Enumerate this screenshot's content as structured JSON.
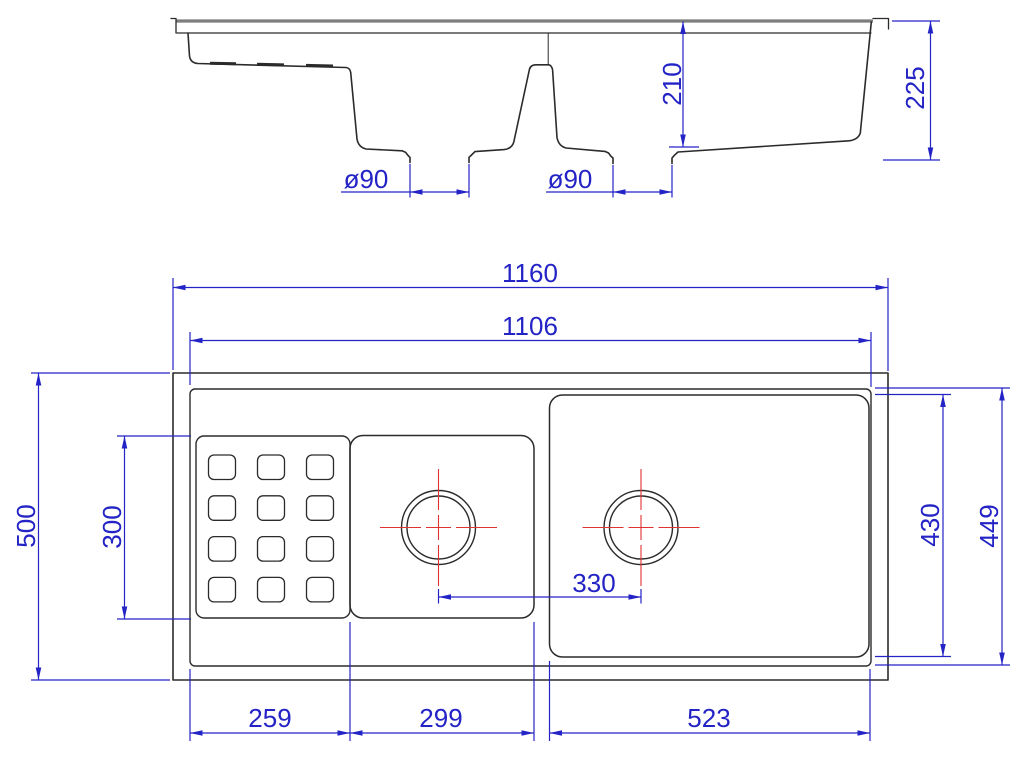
{
  "colors": {
    "dimension": "#2323c6",
    "outline": "#2b2b2b",
    "centerline": "#e03232",
    "countertop": "#7d7d7d",
    "background": "#ffffff"
  },
  "section_view": {
    "dim_drain_left": "ø90",
    "dim_drain_right": "ø90",
    "dim_bowl_depth": "210",
    "dim_overall_depth": "225"
  },
  "plan_view": {
    "dim_overall_width": "1160",
    "dim_rim_inner_width": "1106",
    "dim_overall_front": "500",
    "dim_drainboard_front": "300",
    "dim_drain_spacing": "330",
    "dim_right_bowl_front": "430",
    "dim_rim_inner_front": "449",
    "dim_drainboard_width": "259",
    "dim_middle_bowl_width": "299",
    "dim_right_bowl_width": "523",
    "drainboard_grid": {
      "rows": 4,
      "columns": 3
    },
    "drain_count": 2
  }
}
